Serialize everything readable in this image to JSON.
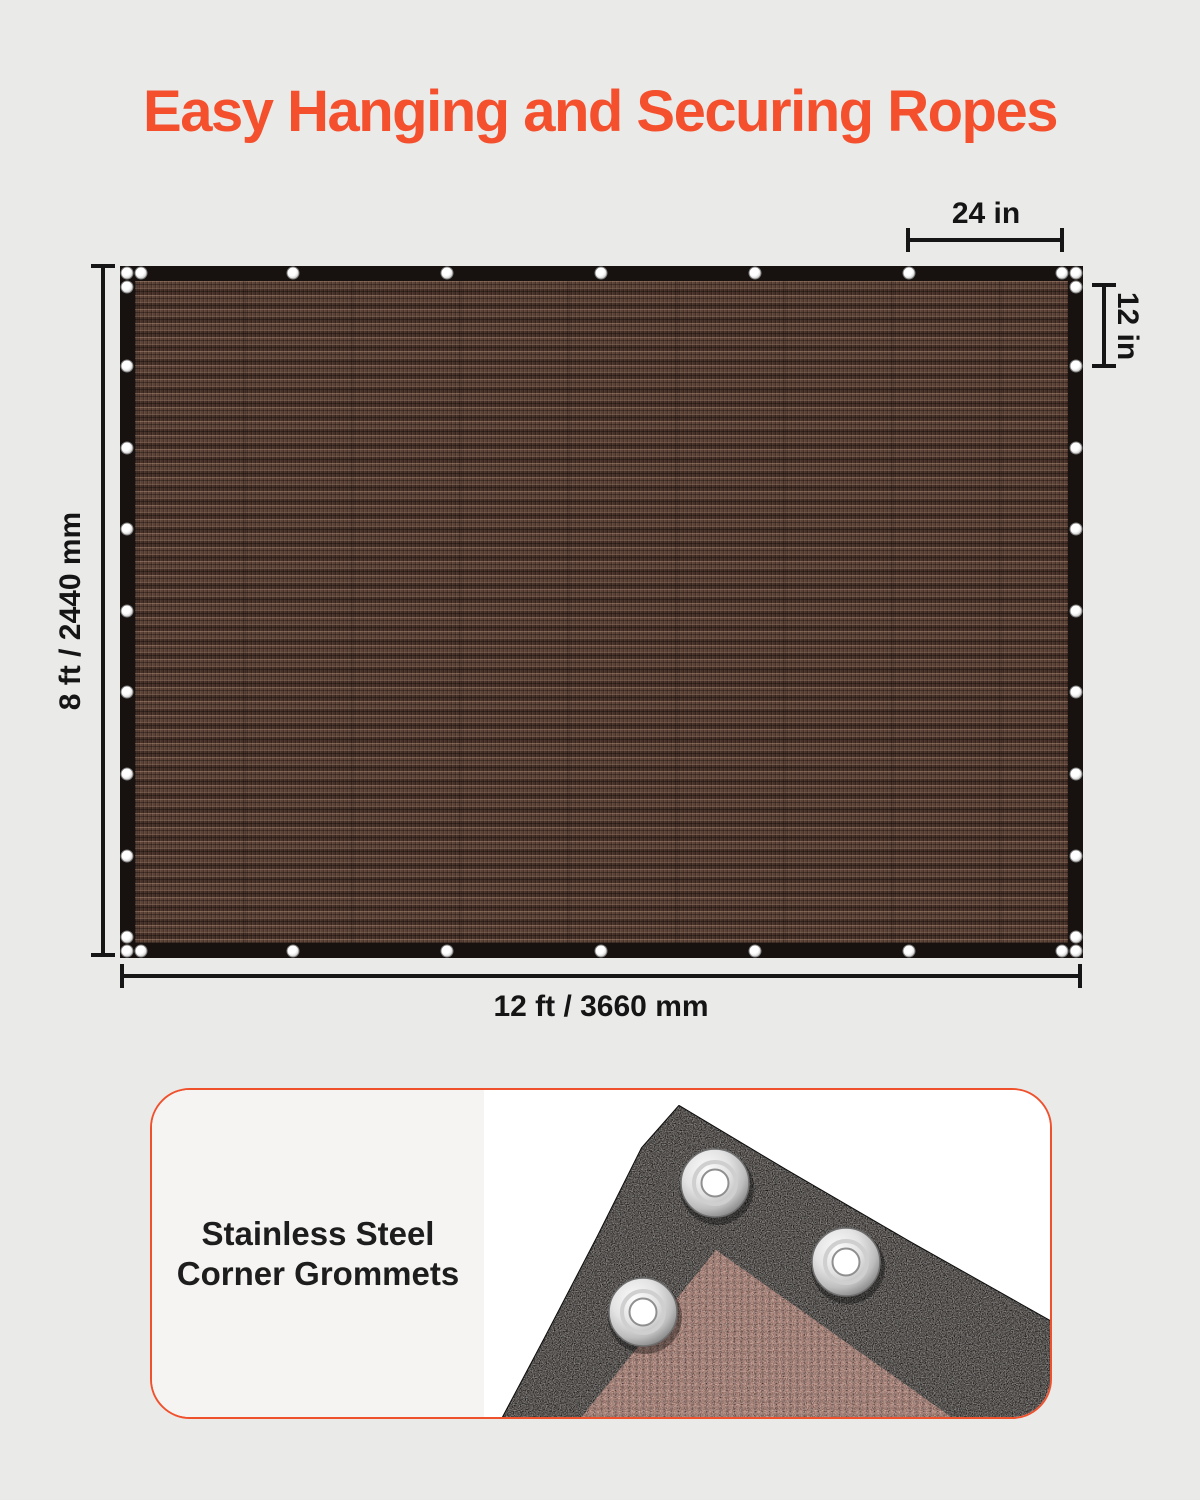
{
  "title": "Easy Hanging and Securing Ropes",
  "theme": {
    "accent_orange": "#F4502E",
    "page_background": "#EAEAE9",
    "dimension_line_color": "#161616",
    "tarp_edge_black": "#17120F",
    "mesh_brown": "#4F392F",
    "card_background": "#FFFFFF",
    "card_left_background": "#F5F4F2",
    "caption_text_color": "#1D1D1D"
  },
  "tarp_diagram": {
    "height_label": "8 ft / 2440 mm",
    "width_label": "12 ft / 3660 mm",
    "top_grommet_spacing_label": "24 in",
    "side_grommet_spacing_label": "12 in"
  },
  "grommet_feature_card": {
    "caption_line1": "Stainless Steel",
    "caption_line2": "Corner Grommets"
  }
}
